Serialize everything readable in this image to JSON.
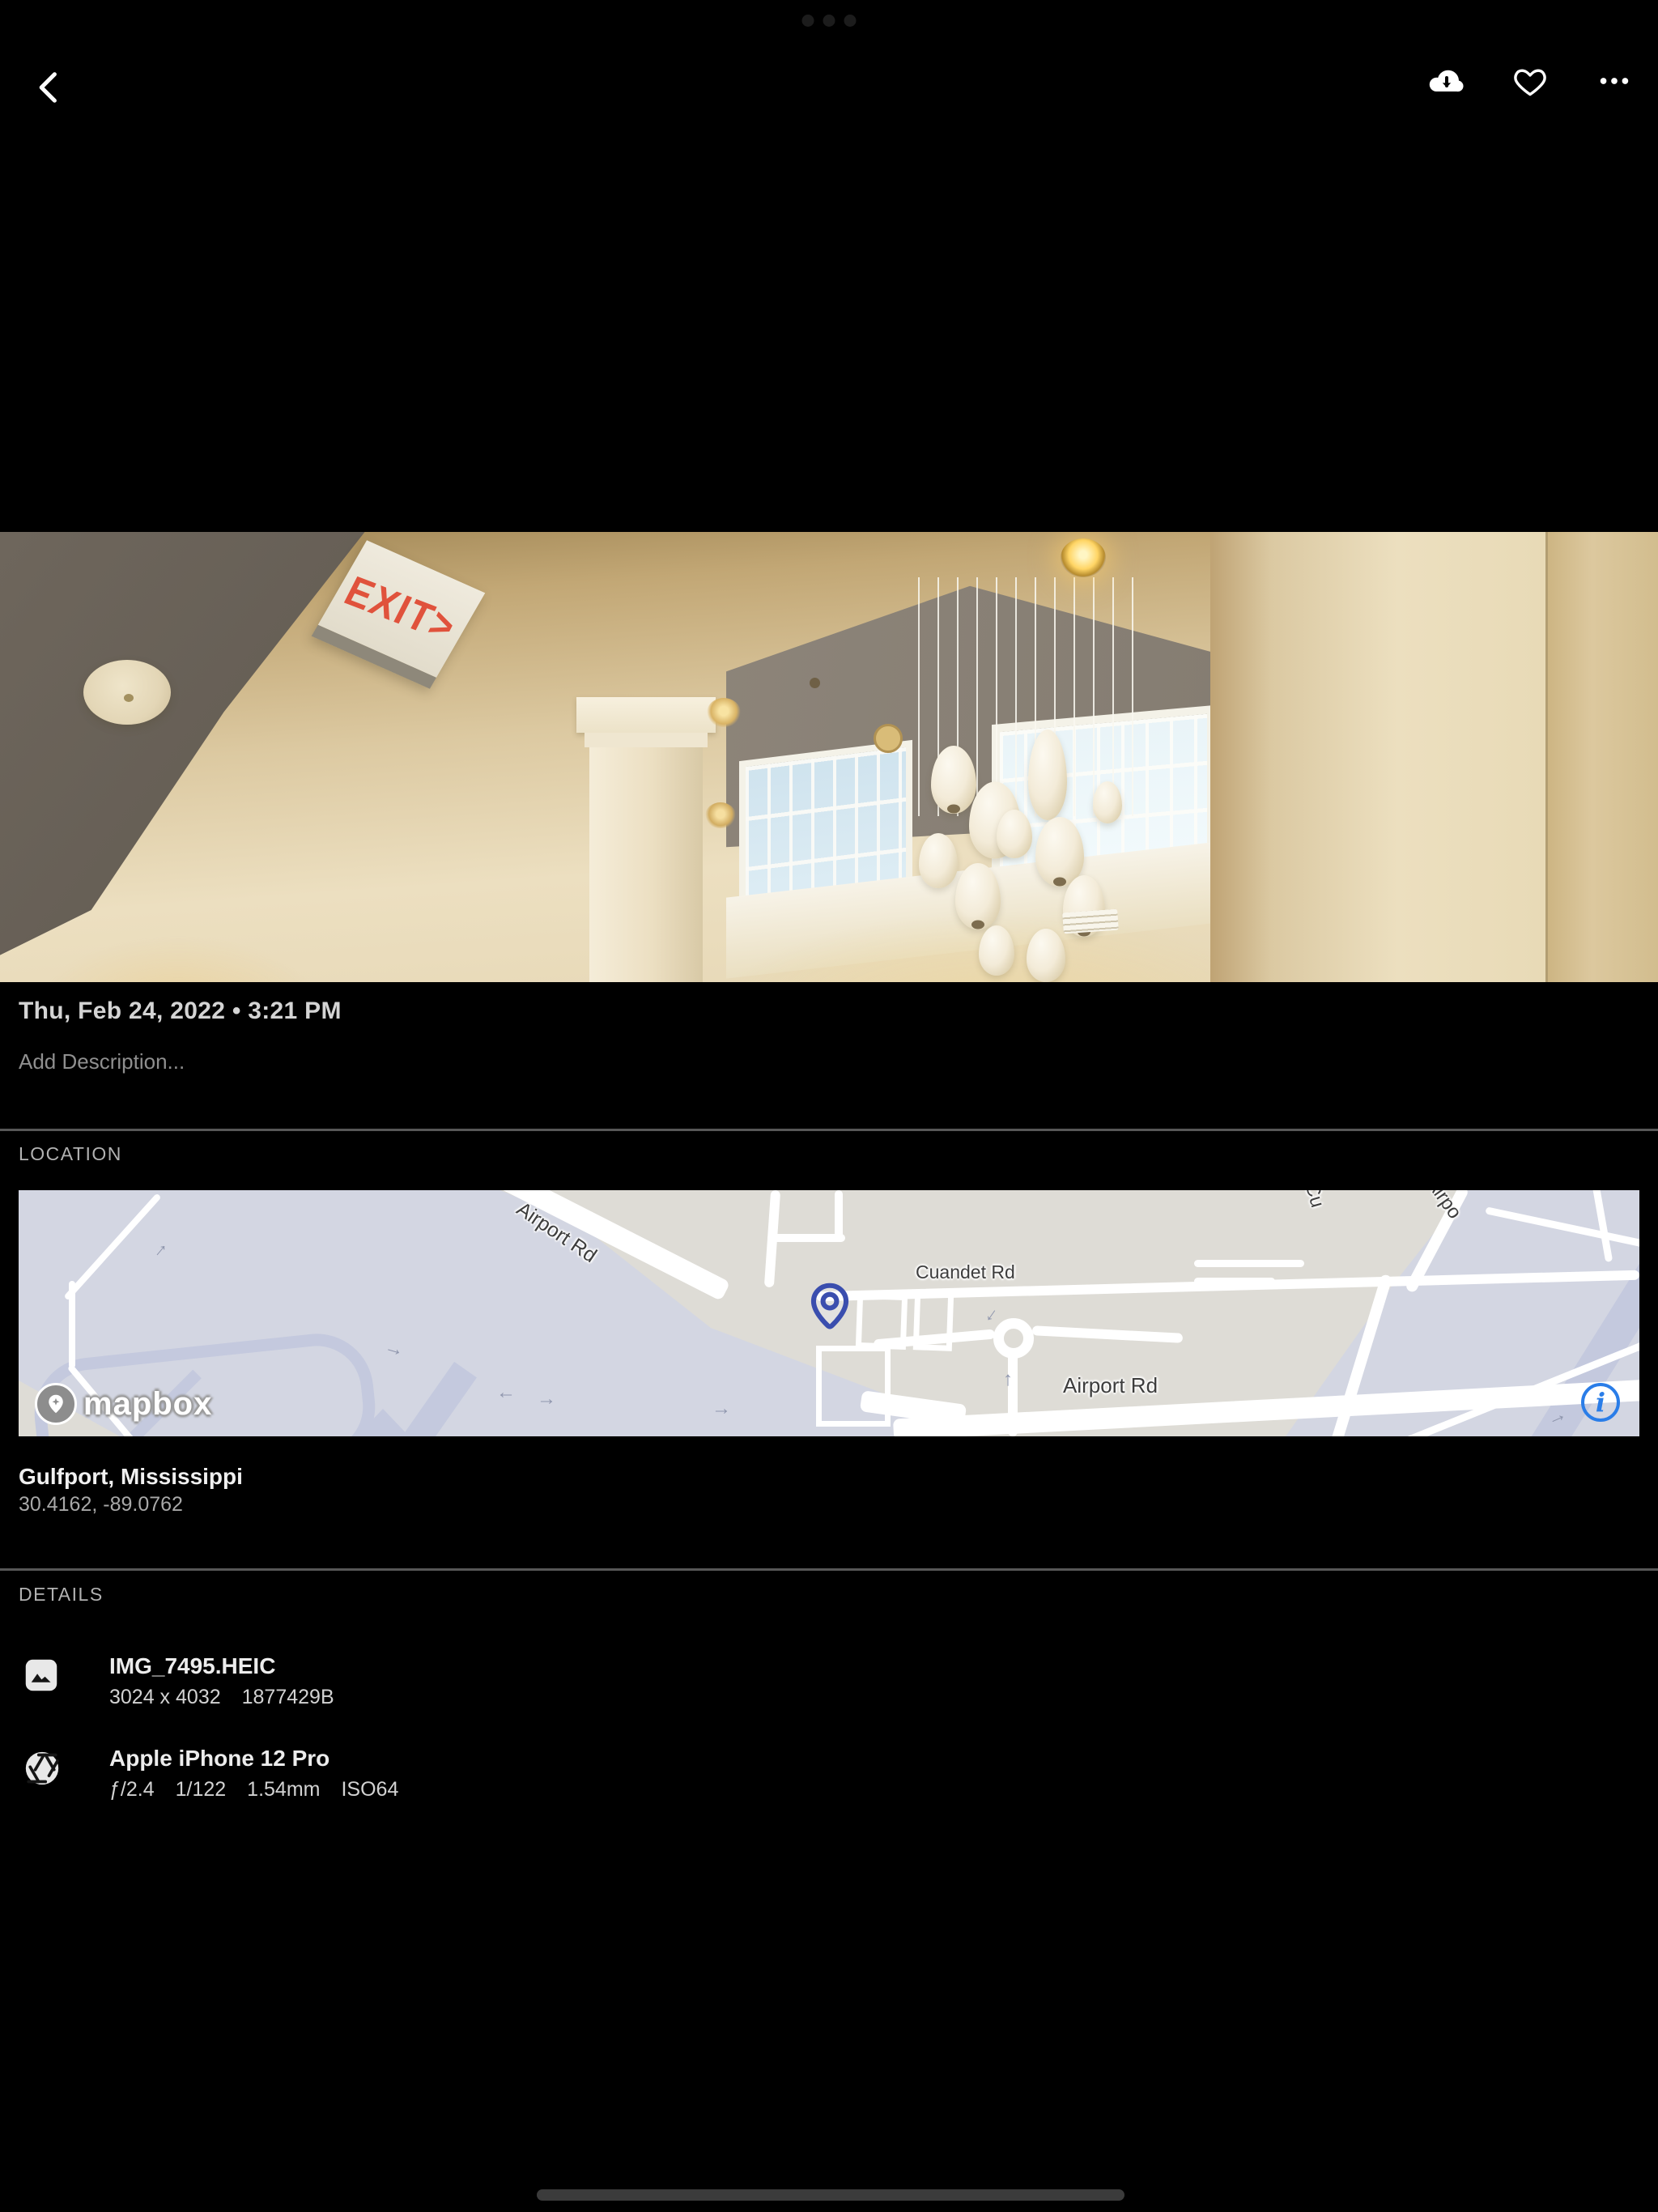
{
  "toolbar": {
    "back_icon": "chevron-left",
    "actions": [
      {
        "id": "download",
        "icon": "cloud-download-icon"
      },
      {
        "id": "favorite",
        "icon": "heart-outline-icon"
      },
      {
        "id": "more",
        "icon": "ellipsis-icon"
      }
    ]
  },
  "photo": {
    "exit_sign_text": "EXIT>",
    "description": "Interior atrium ceiling with EXIT sign, clerestory windows and white pendant lamps"
  },
  "info": {
    "date_line": "Thu, Feb 24, 2022 • 3:21 PM",
    "description_placeholder": "Add Description..."
  },
  "location": {
    "section_label": "LOCATION",
    "place": "Gulfport, Mississippi",
    "coordinates": "30.4162, -89.0762",
    "map": {
      "labels": {
        "airport_rd_diagonal": "Airport Rd",
        "cuandet_rd": "Cuandet Rd",
        "airport_rd_horizontal": "Airport Rd",
        "cut_label_cu": "Cu",
        "cut_label_airpo": "Airpo"
      },
      "attribution": "mapbox",
      "info_glyph": "i",
      "pin_color": "#3a4eae",
      "info_color": "#2a7de8"
    }
  },
  "details": {
    "section_label": "DETAILS",
    "rows": [
      {
        "icon": "image-icon",
        "title": "IMG_7495.HEIC",
        "meta": [
          "3024 x 4032",
          "1877429B"
        ]
      },
      {
        "icon": "aperture-icon",
        "title": "Apple iPhone 12 Pro",
        "meta": [
          "ƒ/2.4",
          "1/122",
          "1.54mm",
          "ISO64"
        ]
      }
    ]
  },
  "colors": {
    "background": "#000000",
    "divider": "#575757",
    "map_land": "#dedcd6",
    "map_low": "#d3d6e2",
    "accent_pin": "#3a4eae",
    "accent_info": "#2a7de8"
  }
}
